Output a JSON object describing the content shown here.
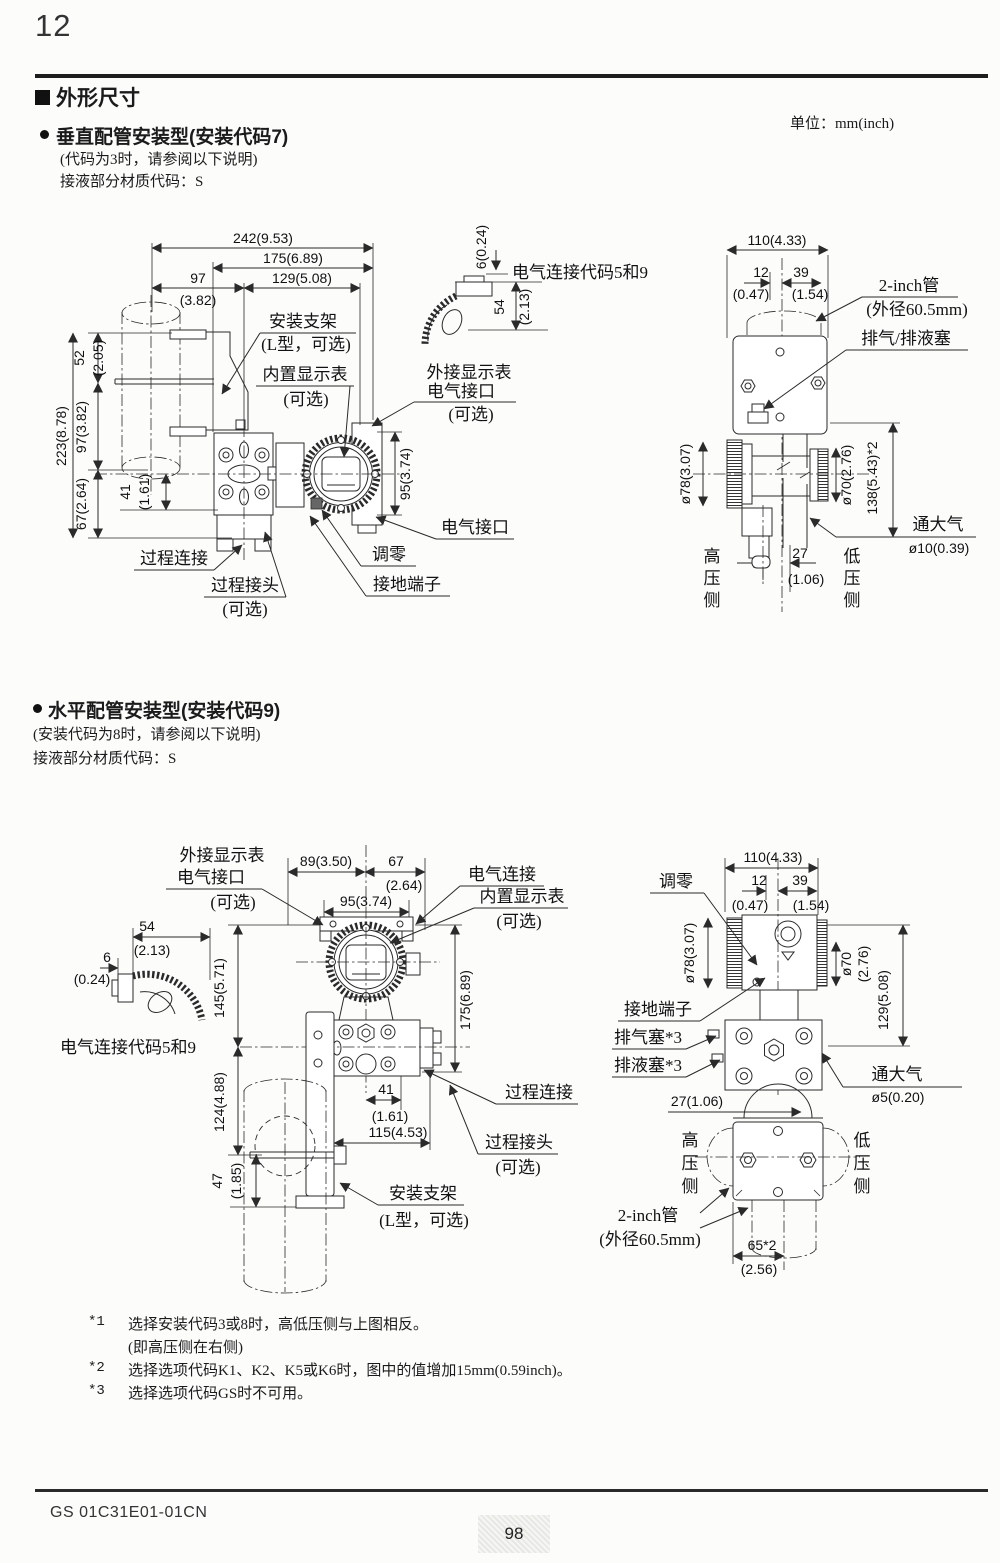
{
  "page": {
    "number": "12",
    "heading": "外形尺寸",
    "unit": "单位：mm(inch)",
    "footer_code": "GS 01C31E01-01CN",
    "footer_page": "98"
  },
  "section1": {
    "title": "垂直配管安装型(安装代码7)",
    "note1": "(代码为3时，请参阅以下说明)",
    "note2": "接液部分材质代码：S",
    "conduit_note": "电气连接代码5和9",
    "dims": {
      "w242": "242(9.53)",
      "w175": "175(6.89)",
      "w97": "97",
      "w97p": "(3.82)",
      "w129": "129(5.08)",
      "h52": "52",
      "h52p": "(2.05)",
      "h223": "223(8.78)",
      "h97": "97(3.82)",
      "h67": "67(2.64)",
      "h41": "41",
      "h41p": "(1.61)",
      "h95": "95(3.74)",
      "d6": "6(0.24)",
      "d54": "54",
      "d54p": "(2.13)"
    },
    "labels": {
      "bracket": "安装支架",
      "bracket2": "(L型，可选)",
      "display": "内置显示表",
      "optional": "(可选)",
      "extdisp": "外接显示表",
      "extdisp2": "电气接口",
      "conn": "电气接口",
      "zero": "调零",
      "ground": "接地端子",
      "process": "过程连接",
      "adapter": "过程接头"
    },
    "right": {
      "w110": "110(4.33)",
      "w12": "12",
      "w12p": "(0.47)",
      "w39": "39",
      "w39p": "(1.54)",
      "pipe": "2-inch管",
      "pipe2": "(外径60.5mm)",
      "plug": "排气/排液塞",
      "d78": "ø78(3.07)",
      "d70": "ø70(2.76)",
      "h138": "138(5.43)*2",
      "atm": "通大气",
      "atm2": "ø10(0.39)",
      "w27": "27",
      "w27p": "(1.06)",
      "hp": [
        "高",
        "压",
        "侧"
      ],
      "lp": [
        "低",
        "压",
        "侧"
      ]
    }
  },
  "section2": {
    "title": "水平配管安装型(安装代码9)",
    "note1": "(安装代码为8时，请参阅以下说明)",
    "note2": "接液部分材质代码：S",
    "conduit_note": "电气连接代码5和9",
    "left": {
      "w89": "89(3.50)",
      "w67": "67",
      "w67p": "(2.64)",
      "w95": "95(3.74)",
      "d54": "54",
      "d54p": "(2.13)",
      "d6": "6",
      "d6p": "(0.24)",
      "h145": "145(5.71)",
      "h175": "175(6.89)",
      "h124": "124(4.88)",
      "h47": "47",
      "h47p": "(1.85)",
      "w41": "41",
      "w41p": "(1.61)",
      "w115": "115(4.53)",
      "extdisp": "外接显示表",
      "extdisp2": "电气接口",
      "optional": "(可选)",
      "conn": "电气连接",
      "display": "内置显示表",
      "process": "过程连接",
      "adapter": "过程接头",
      "bracket": "安装支架",
      "bracket2": "(L型，可选)"
    },
    "right": {
      "zero": "调零",
      "w110": "110(4.33)",
      "w12": "12",
      "w12p": "(0.47)",
      "w39": "39",
      "w39p": "(1.54)",
      "d78": "ø78(3.07)",
      "d70": "ø70",
      "d70p": "(2.76)",
      "h129": "129(5.08)",
      "ground": "接地端子",
      "vent": "排气塞*3",
      "drain": "排液塞*3",
      "atm": "通大气",
      "atm2": "ø5(0.20)",
      "w27": "27(1.06)",
      "pipe": "2-inch管",
      "pipe2": "(外径60.5mm)",
      "h65": "65*2",
      "h65p": "(2.56)",
      "hp": [
        "高",
        "压",
        "侧"
      ],
      "lp": [
        "低",
        "压",
        "侧"
      ]
    }
  },
  "footnotes": [
    {
      "marker": "*1",
      "line1": "选择安装代码3或8时，高低压侧与上图相反。",
      "line2": "(即高压侧在右侧)"
    },
    {
      "marker": "*2",
      "line1": "选择选项代码K1、K2、K5或K6时，图中的值增加15mm(0.59inch)。",
      "line2": ""
    },
    {
      "marker": "*3",
      "line1": "选择选项代码GS时不可用。",
      "line2": ""
    }
  ]
}
